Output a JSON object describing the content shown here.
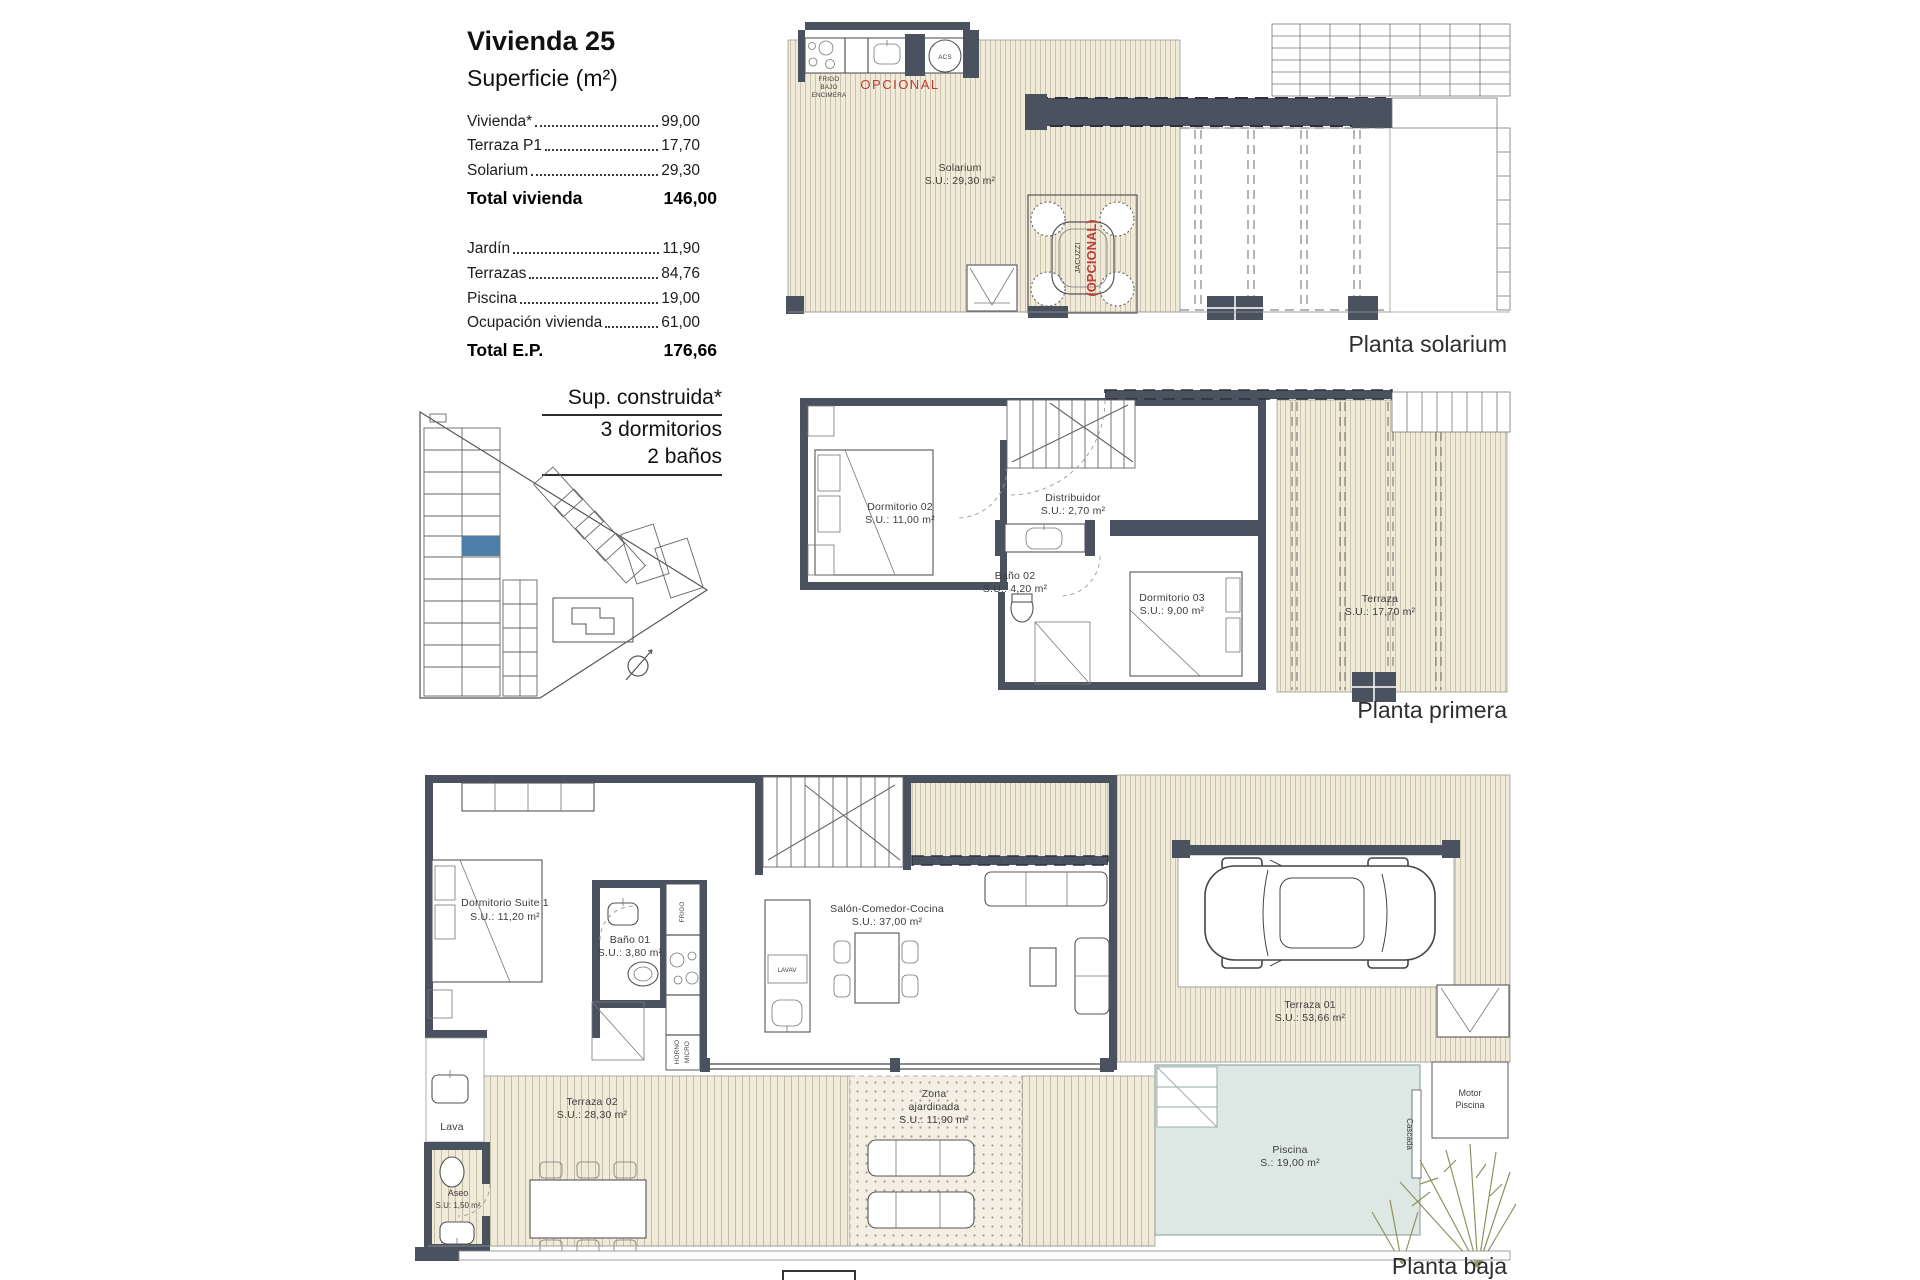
{
  "info_panel": {
    "title": "Vivienda 25",
    "subtitle": "Superficie (m²)",
    "surface_table": {
      "rows": [
        {
          "label": "Vivienda*",
          "value": "99,00"
        },
        {
          "label": "Terraza P1",
          "value": "17,70"
        },
        {
          "label": "Solarium",
          "value": "29,30"
        }
      ],
      "total_row": {
        "label": "Total vivienda",
        "value": "146,00"
      },
      "rows2": [
        {
          "label": "Jardín",
          "value": "11,90"
        },
        {
          "label": "Terrazas",
          "value": "84,76"
        },
        {
          "label": "Piscina",
          "value": "19,00"
        },
        {
          "label": "Ocupación vivienda",
          "value": "61,00"
        }
      ],
      "total_ep_row": {
        "label": "Total E.P.",
        "value": "176,66"
      }
    },
    "built_note": {
      "line1": "Sup. construida*",
      "line2": "3 dormitorios",
      "line3": "2 baños"
    }
  },
  "plan_solarium": {
    "title": "Planta solarium",
    "room": {
      "name": "Solarium",
      "area": "S.U.: 29,30 m²"
    },
    "kitchen": {
      "line1": "FRIGO",
      "line2": "BAJO",
      "line3": "ENCIMERA",
      "optional": "OPCIONAL",
      "acs": "ACS"
    },
    "jacuzzi": {
      "name": "JACUZZI",
      "optional": "(OPCIONAL)"
    }
  },
  "plan_primera": {
    "title": "Planta primera",
    "rooms": [
      {
        "name": "Dormitorio 02",
        "area": "S.U.: 11,00 m²"
      },
      {
        "name": "Baño 02",
        "area": "S.U.: 4,20 m²"
      },
      {
        "name": "Distribuidor",
        "area": "S.U.: 2,70 m²"
      },
      {
        "name": "Dormitorio 03",
        "area": "S.U.: 9,00 m²"
      },
      {
        "name": "Terraza",
        "area": "S.U.: 17,70 m²"
      }
    ]
  },
  "plan_baja": {
    "title": "Planta baja",
    "rooms": [
      {
        "name": "Dormitorio Suite 1",
        "area": "S.U.: 11,20 m²"
      },
      {
        "name": "Baño 01",
        "area": "S.U.: 3,80 m²"
      },
      {
        "name": "Salón-Comedor-Cocina",
        "area": "S.U.: 37,00 m²"
      },
      {
        "name": "Terraza 02",
        "area": "S.U.: 28,30 m²"
      },
      {
        "name": "Terraza 01",
        "area": "S.U.: 53,66 m²"
      },
      {
        "name": "Piscina",
        "area": "S.: 19,00 m²"
      },
      {
        "name": "Aseo",
        "area": "S.U: 1,50 m²"
      }
    ],
    "garden": {
      "line1": "Zona",
      "line2": "ajardinada",
      "area": "S.U.: 11,90 m²"
    },
    "labels": {
      "lava": "Lava",
      "lavav": "LAVAV",
      "frigo": "FRIGO",
      "horno": "HORNO",
      "micro": "MICRO",
      "motor1": "Motor",
      "motor2": "Piscina",
      "cascada": "Cascada"
    }
  },
  "colors": {
    "wall": "#4a5260",
    "deck_bg": "#f0ead9",
    "deck_line": "#ccc4ae",
    "pool": "#dde8e4",
    "unit_highlight": "#4d7ea8",
    "accent_red": "#c23b33",
    "plant_green": "#8f9160"
  }
}
